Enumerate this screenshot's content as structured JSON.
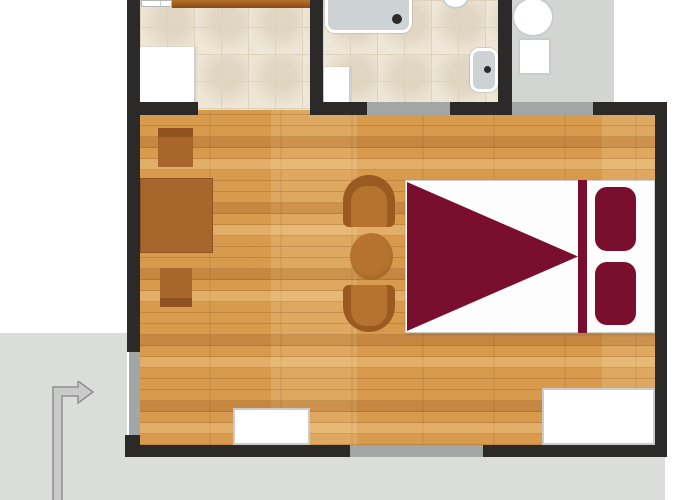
{
  "plan": {
    "colors": {
      "wall": "#2b2a28",
      "window": "#a2a6a4",
      "outside": "#dbddda",
      "terrace": "#d2d5d2",
      "maroon": "#7a0e2f",
      "brown": "#a9662c",
      "brown_dark": "#9a5a20",
      "brown_light": "#b5732f",
      "fixture": "#cdd3d4",
      "drain": "#2b2b2b",
      "arrow_fill": "#cacaca",
      "arrow_stroke": "#8f8f8f"
    },
    "regions": [
      {
        "name": "outside-area-bottom-left",
        "x": 0,
        "y": 333,
        "w": 127,
        "h": 167,
        "color": "outside"
      },
      {
        "name": "outside-area-bottom",
        "x": 127,
        "y": 457,
        "w": 538,
        "h": 43,
        "color": "outside"
      },
      {
        "name": "terrace-floor",
        "x": 512,
        "y": 0,
        "w": 102,
        "h": 102,
        "color": "terrace"
      }
    ],
    "floors": [
      {
        "name": "kitchen-floor",
        "x": 140,
        "y": 0,
        "w": 172,
        "h": 110,
        "cls": "tile"
      },
      {
        "name": "bathroom-floor",
        "x": 323,
        "y": 0,
        "w": 175,
        "h": 106,
        "cls": "tile"
      },
      {
        "name": "living-room-floor",
        "x": 138,
        "y": 110,
        "w": 517,
        "h": 335,
        "cls": "wood"
      }
    ],
    "thresholds": [
      {
        "name": "bathroom-door-threshold",
        "x": 367,
        "y": 102,
        "w": 83,
        "h": 13,
        "color": "window"
      },
      {
        "name": "terrace-door-threshold",
        "x": 512,
        "y": 102,
        "w": 81,
        "h": 13,
        "color": "window"
      },
      {
        "name": "window-left",
        "x": 129,
        "y": 352,
        "w": 11,
        "h": 83,
        "color": "window"
      },
      {
        "name": "window-bottom",
        "x": 350,
        "y": 445,
        "w": 133,
        "h": 12,
        "color": "window"
      }
    ],
    "furniture": [
      {
        "name": "kitchen-counter",
        "x": 172,
        "y": 0,
        "w": 138,
        "h": 8,
        "cls": "counter"
      },
      {
        "name": "kitchen-sink-unit",
        "x": 141,
        "y": 0,
        "w": 31,
        "h": 7,
        "cls": "sink-unit"
      },
      {
        "name": "kitchen-door-leaf",
        "x": 137,
        "y": 47,
        "w": 59,
        "h": 55,
        "cls": "door-leaf"
      },
      {
        "name": "shower-tray",
        "x": 325,
        "y": -4,
        "w": 87,
        "h": 37,
        "cls": "rim-box",
        "color": "fixture",
        "radius": "0 0 10px 10px"
      },
      {
        "name": "shower-drain",
        "x": 392,
        "y": 14,
        "w": 10,
        "h": 10,
        "color": "drain",
        "radius": "50%"
      },
      {
        "name": "bathroom-sink",
        "x": 441,
        "y": -20,
        "w": 29,
        "h": 29,
        "cls": "white-item",
        "radius": "50%"
      },
      {
        "name": "wall-basin",
        "x": 470,
        "y": 48,
        "w": 28,
        "h": 44,
        "cls": "rim-box",
        "color": "fixture",
        "radius": "9px"
      },
      {
        "name": "wall-basin-drain",
        "x": 484,
        "y": 66,
        "w": 7,
        "h": 7,
        "color": "drain",
        "radius": "50%"
      },
      {
        "name": "bathroom-door-leaf",
        "x": 324,
        "y": 67,
        "w": 27,
        "h": 35,
        "cls": "door-leaf"
      },
      {
        "name": "terrace-table",
        "x": 512,
        "y": -3,
        "w": 42,
        "h": 40,
        "cls": "white-item",
        "radius": "50%"
      },
      {
        "name": "terrace-chair",
        "x": 518,
        "y": 38,
        "w": 33,
        "h": 37,
        "cls": "white-item"
      },
      {
        "name": "desk-chair-top",
        "x": 158,
        "y": 128,
        "w": 35,
        "h": 39,
        "cls": "back-top"
      },
      {
        "name": "desk",
        "x": 140,
        "y": 178,
        "w": 73,
        "h": 75,
        "color": "brown",
        "border": "1px solid #8f5424"
      },
      {
        "name": "desk-chair-bottom",
        "x": 160,
        "y": 268,
        "w": 32,
        "h": 39,
        "cls": "back-bottom"
      },
      {
        "name": "armchair-top-back",
        "x": 343,
        "y": 175,
        "w": 52,
        "h": 52,
        "color": "brown_dark",
        "radius": "26px 26px 6px 6px"
      },
      {
        "name": "armchair-top-seat",
        "x": 351,
        "y": 186,
        "w": 36,
        "h": 41,
        "color": "brown_light",
        "radius": "15px 15px 2px 2px"
      },
      {
        "name": "coffee-table",
        "x": 350,
        "y": 233,
        "w": 43,
        "h": 47,
        "cls": "round-table"
      },
      {
        "name": "armchair-bottom-back",
        "x": 343,
        "y": 285,
        "w": 52,
        "h": 47,
        "color": "brown_dark",
        "radius": "6px 6px 26px 26px"
      },
      {
        "name": "armchair-bottom-seat",
        "x": 351,
        "y": 285,
        "w": 36,
        "h": 41,
        "color": "brown_light",
        "radius": "2px 2px 15px 15px"
      },
      {
        "name": "double-bed",
        "x": 405,
        "y": 180,
        "w": 250,
        "h": 153,
        "cls": "bed"
      },
      {
        "name": "bed-blanket-triangle",
        "x": 407,
        "y": 182,
        "w": 171,
        "h": 149,
        "cls": "triangle",
        "color": "maroon"
      },
      {
        "name": "bed-headboard-stripe",
        "x": 578,
        "y": 180,
        "w": 9,
        "h": 153,
        "color": "maroon"
      },
      {
        "name": "pillow-top",
        "x": 595,
        "y": 187,
        "w": 41,
        "h": 64,
        "color": "maroon",
        "radius": "12px"
      },
      {
        "name": "pillow-bottom",
        "x": 595,
        "y": 262,
        "w": 41,
        "h": 63,
        "color": "maroon",
        "radius": "12px"
      },
      {
        "name": "bench-bottom-wall",
        "x": 233,
        "y": 408,
        "w": 77,
        "h": 37,
        "cls": "white-item"
      },
      {
        "name": "cabinet-bottom-right",
        "x": 542,
        "y": 388,
        "w": 113,
        "h": 57,
        "cls": "white-item"
      }
    ],
    "walls": [
      {
        "name": "wall-left",
        "x": 127,
        "y": 0,
        "w": 13,
        "h": 352,
        "color": "wall"
      },
      {
        "name": "wall-left-corner",
        "x": 125,
        "y": 435,
        "w": 15,
        "h": 22,
        "color": "wall"
      },
      {
        "name": "wall-top-kitchen",
        "x": 127,
        "y": 102,
        "w": 71,
        "h": 13,
        "color": "wall"
      },
      {
        "name": "wall-kitchen-bathroom",
        "x": 310,
        "y": 0,
        "w": 13,
        "h": 102,
        "color": "wall"
      },
      {
        "name": "wall-top-middle",
        "x": 310,
        "y": 102,
        "w": 57,
        "h": 13,
        "color": "wall"
      },
      {
        "name": "wall-bathroom-right",
        "x": 498,
        "y": 0,
        "w": 14,
        "h": 115,
        "color": "wall"
      },
      {
        "name": "wall-top-right-a",
        "x": 450,
        "y": 102,
        "w": 62,
        "h": 13,
        "color": "wall"
      },
      {
        "name": "wall-top-right-b",
        "x": 593,
        "y": 102,
        "w": 74,
        "h": 13,
        "color": "wall"
      },
      {
        "name": "wall-right",
        "x": 655,
        "y": 102,
        "w": 12,
        "h": 355,
        "color": "wall"
      },
      {
        "name": "wall-bottom-left",
        "x": 125,
        "y": 445,
        "w": 225,
        "h": 12,
        "color": "wall"
      },
      {
        "name": "wall-bottom-right",
        "x": 483,
        "y": 445,
        "w": 184,
        "h": 12,
        "color": "wall"
      }
    ]
  }
}
